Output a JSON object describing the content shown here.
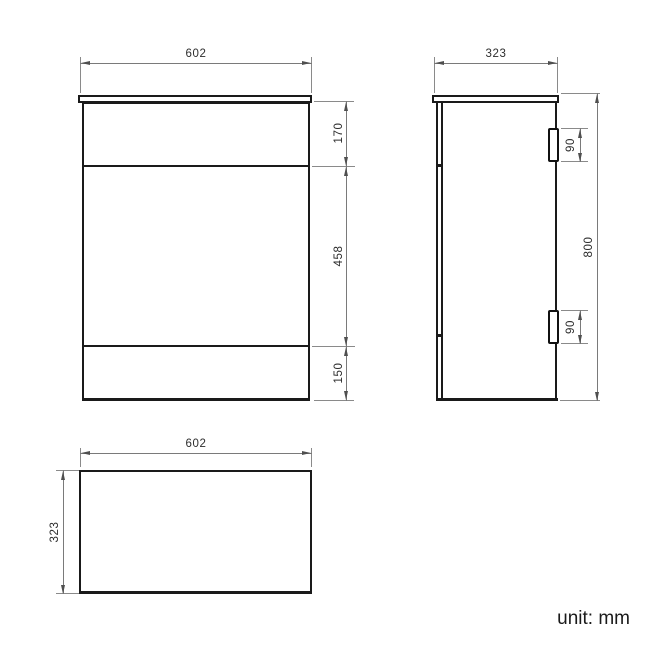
{
  "unit_note": "unit: mm",
  "colors": {
    "outline": "#1a1a1a",
    "dimension_line": "#7a7a7a",
    "label_text": "#2d2d2d",
    "background": "#ffffff"
  },
  "front_view": {
    "width": "602",
    "sections": {
      "top": "170",
      "middle": "458",
      "bottom": "150"
    }
  },
  "side_view": {
    "depth": "323",
    "height": "800",
    "hinge_top_height": "90",
    "hinge_bottom_height": "90"
  },
  "top_view": {
    "width": "602",
    "depth": "323"
  }
}
